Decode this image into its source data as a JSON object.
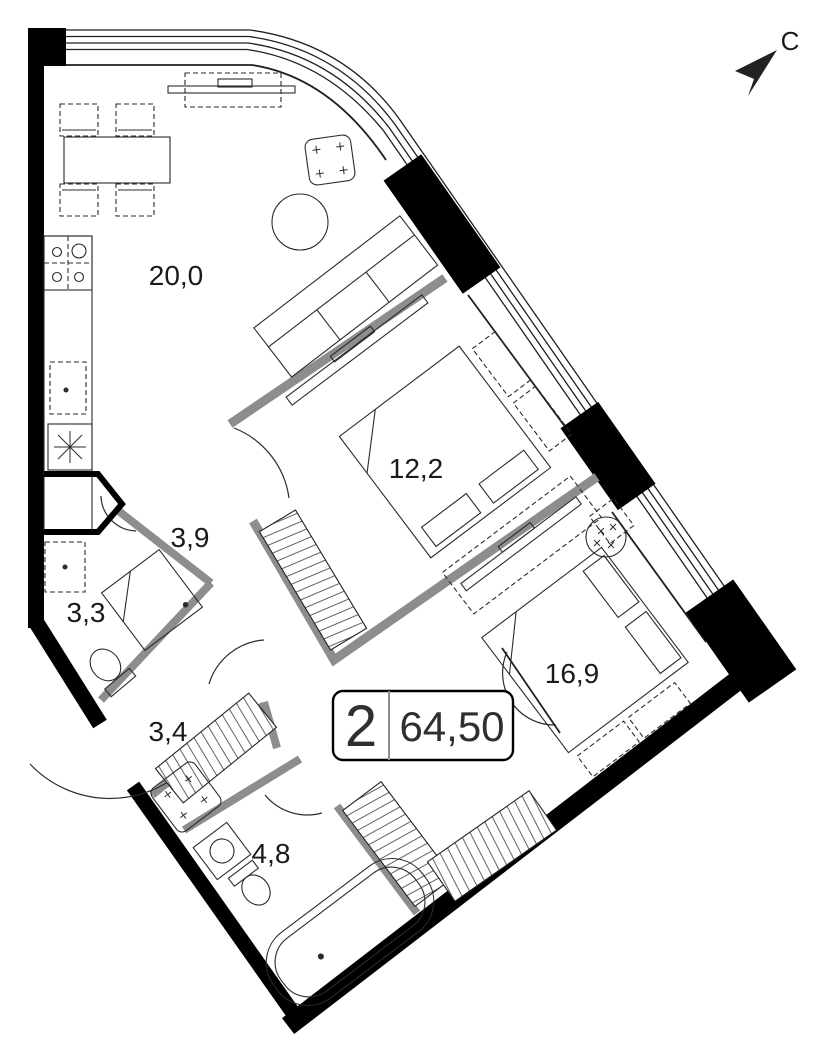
{
  "title": "apartment-floor-plan",
  "badge": {
    "rooms_count": "2",
    "total_area": "64,50"
  },
  "compass": {
    "north_label": "С"
  },
  "rooms": [
    {
      "name": "kitchen-living-room",
      "area": "20,0"
    },
    {
      "name": "bedroom-1",
      "area": "12,2"
    },
    {
      "name": "bedroom-2",
      "area": "16,9"
    },
    {
      "name": "hallway",
      "area": "3,9"
    },
    {
      "name": "bathroom-1",
      "area": "3,3"
    },
    {
      "name": "entry-hall",
      "area": "3,4"
    },
    {
      "name": "bathroom-2",
      "area": "4,8"
    }
  ],
  "colors": {
    "exterior_wall": "#000000",
    "partition_wall": "#8d8d8d",
    "line": "#1f1f1f",
    "background": "#ffffff",
    "text": "#1a1a1a"
  },
  "furniture_icons": [
    "dining-table-icon",
    "chair-icon",
    "tv-stand-icon",
    "armchair-icon",
    "coffee-table-icon",
    "sofa-icon",
    "stove-icon",
    "kitchen-sink-icon",
    "vent-shaft-icon",
    "double-bed-icon",
    "nightstand-icon",
    "wardrobe-hatched-icon",
    "washing-machine-icon",
    "shower-icon",
    "toilet-icon",
    "bathtub-icon",
    "wash-basin-icon",
    "ceiling-light-icon",
    "north-arrow-icon"
  ]
}
